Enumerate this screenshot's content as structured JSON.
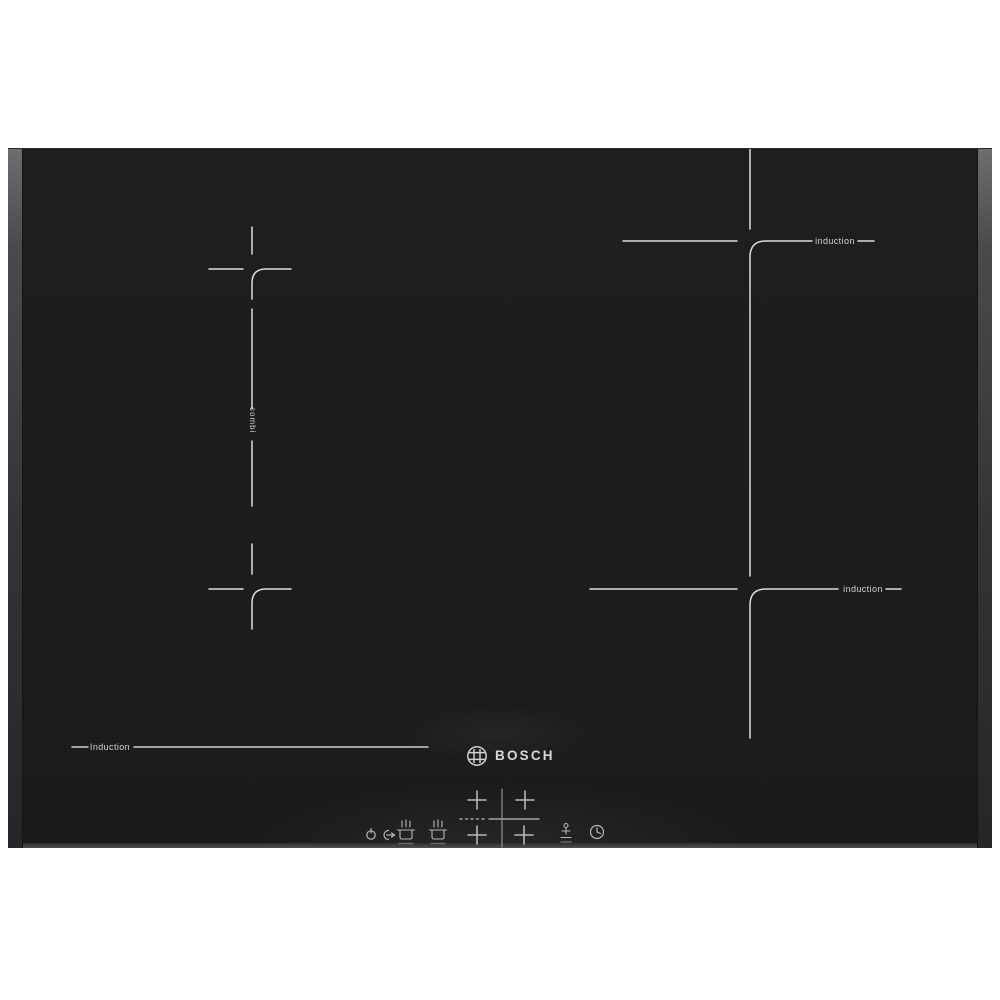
{
  "brand": {
    "name": "BOSCH"
  },
  "zone_labels": {
    "top_right": "induction",
    "bottom_right": "induction",
    "bottom_left": "Induction",
    "combi": "combi"
  },
  "icons": {
    "emblem": "bosch-armature-icon",
    "power_restart": "power-restart-icon",
    "pan_front": "pan-sensor-icon",
    "pan_rear": "pan-sensor-icon",
    "zone_select": "plus-key-icon",
    "pause": "pause-function-icon",
    "timer": "clock-timer-icon"
  },
  "colors": {
    "background": "#ffffff",
    "glass": "#1d1d1f",
    "marking": "#ededed",
    "bevel": "#565658",
    "label": "#d2d2d2",
    "control": "#c8c8c8"
  }
}
